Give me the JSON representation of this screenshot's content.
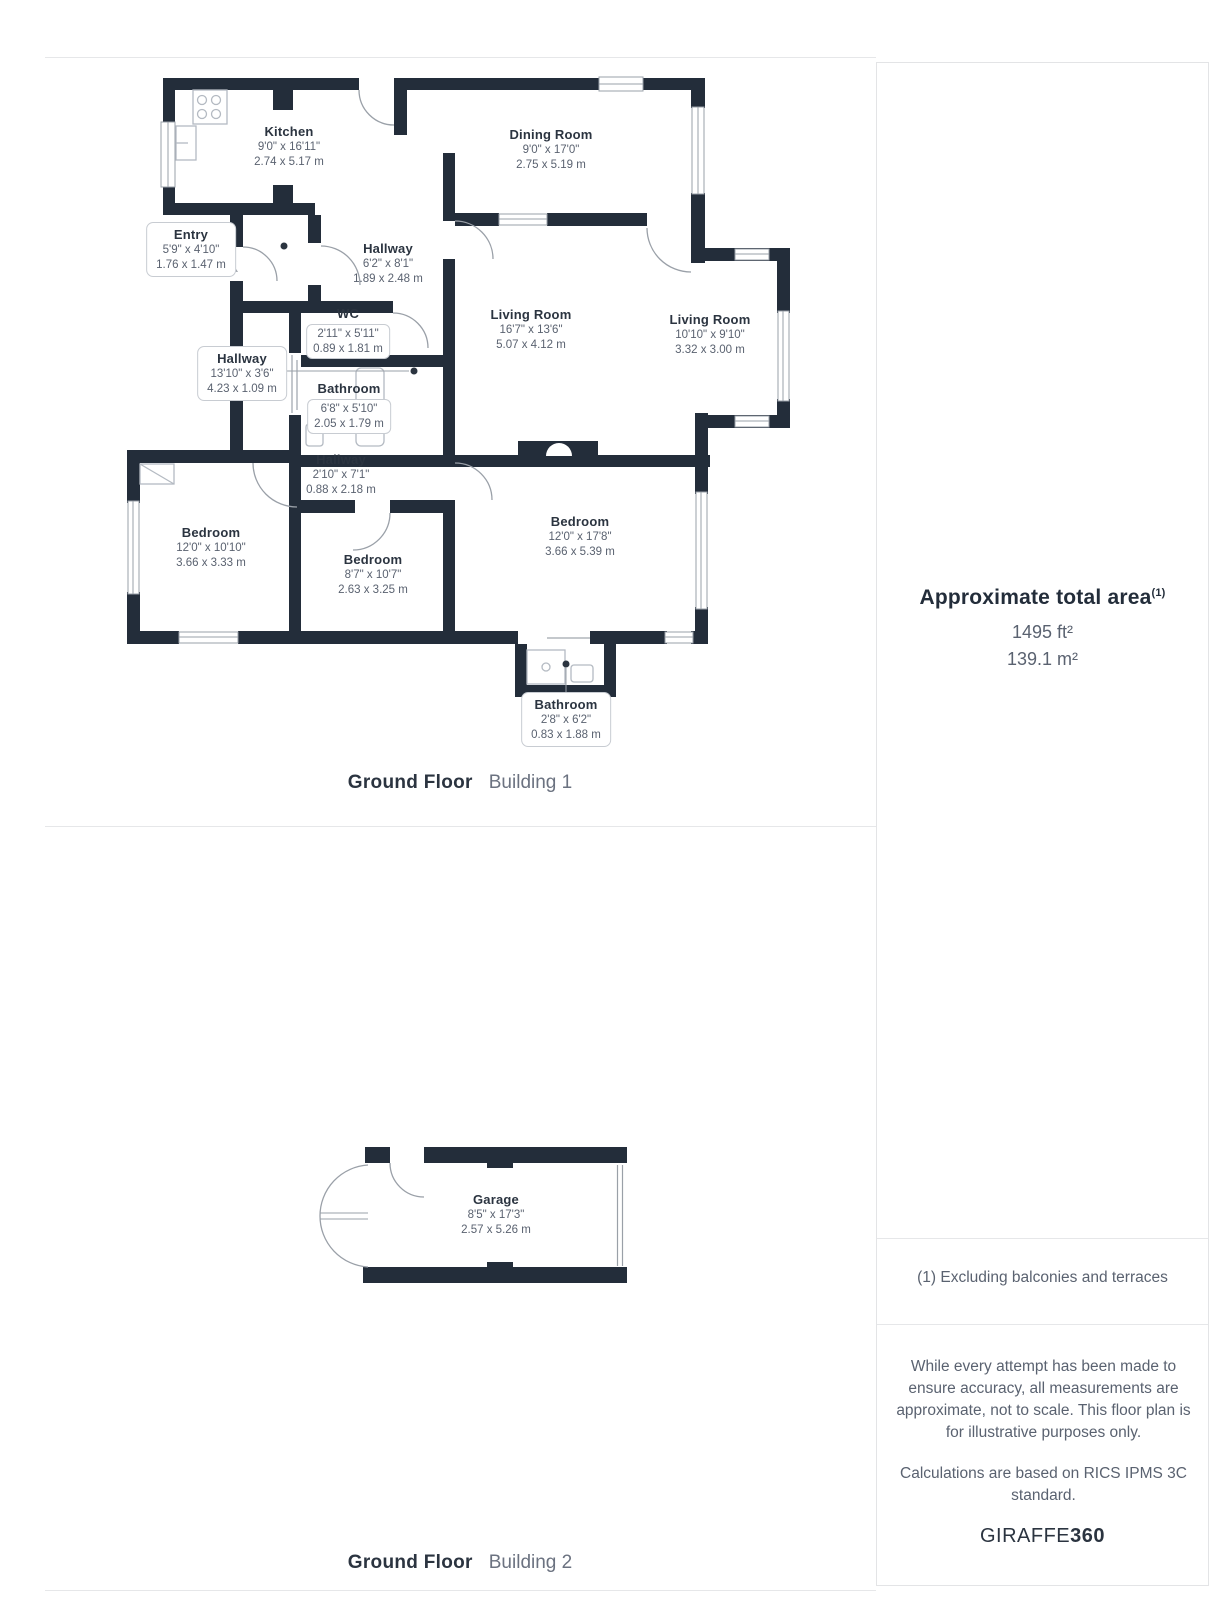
{
  "colors": {
    "wall": "#232d3a",
    "window_line": "#9aa0a8",
    "divider": "#e6e7e9",
    "dim_text": "#5a6270",
    "title_text": "#2b3440"
  },
  "plan1": {
    "caption_bold": "Ground Floor",
    "caption_light": "Building 1",
    "rooms": [
      {
        "name": "Kitchen",
        "imperial": "9'0\" x 16'11\"",
        "metric": "2.74 x 5.17 m"
      },
      {
        "name": "Dining Room",
        "imperial": "9'0\" x 17'0\"",
        "metric": "2.75 x 5.19 m"
      },
      {
        "name": "Entry",
        "imperial": "5'9\" x 4'10\"",
        "metric": "1.76 x 1.47 m"
      },
      {
        "name": "Hallway",
        "imperial": "6'2\" x 8'1\"",
        "metric": "1.89 x 2.48 m"
      },
      {
        "name": "WC",
        "imperial": "2'11\" x 5'11\"",
        "metric": "0.89 x 1.81 m"
      },
      {
        "name": "Hallway",
        "imperial": "13'10\" x 3'6\"",
        "metric": "4.23 x 1.09 m"
      },
      {
        "name": "Living Room",
        "imperial": "16'7\" x 13'6\"",
        "metric": "5.07 x 4.12 m"
      },
      {
        "name": "Living Room",
        "imperial": "10'10\" x 9'10\"",
        "metric": "3.32 x 3.00 m"
      },
      {
        "name": "Bathroom",
        "imperial": "6'8\" x 5'10\"",
        "metric": "2.05 x 1.79 m"
      },
      {
        "name": "Hallway",
        "imperial": "2'10\" x 7'1\"",
        "metric": "0.88 x 2.18 m"
      },
      {
        "name": "Bedroom",
        "imperial": "12'0\" x 10'10\"",
        "metric": "3.66 x 3.33 m"
      },
      {
        "name": "Bedroom",
        "imperial": "8'7\" x 10'7\"",
        "metric": "2.63 x 3.25 m"
      },
      {
        "name": "Bedroom",
        "imperial": "12'0\" x 17'8\"",
        "metric": "3.66 x 5.39 m"
      },
      {
        "name": "Bathroom",
        "imperial": "2'8\" x 6'2\"",
        "metric": "0.83 x 1.88 m"
      }
    ]
  },
  "plan2": {
    "caption_bold": "Ground Floor",
    "caption_light": "Building 2",
    "rooms": [
      {
        "name": "Garage",
        "imperial": "8'5\" x 17'3\"",
        "metric": "2.57 x 5.26 m"
      }
    ]
  },
  "sidebar": {
    "area_title": "Approximate total area",
    "area_superscript": "(1)",
    "area_ft": "1495 ft²",
    "area_m": "139.1 m²",
    "note": "(1) Excluding balconies and terraces",
    "disclaimer1": "While every attempt has been made to ensure accuracy, all measurements are approximate, not to scale. This floor plan is for illustrative purposes only.",
    "disclaimer2": "Calculations are based on RICS IPMS 3C standard.",
    "brand_regular": "GIRAFFE",
    "brand_bold": "360"
  }
}
